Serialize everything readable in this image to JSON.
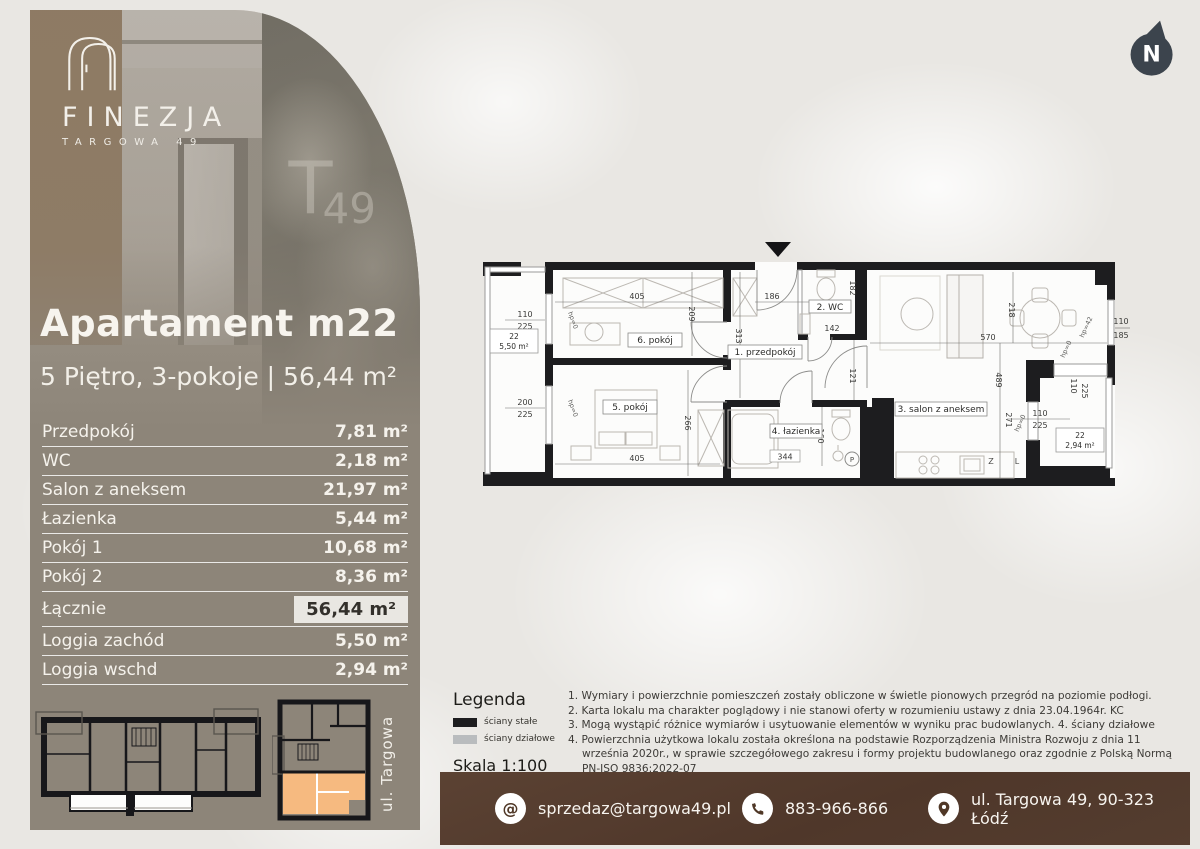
{
  "brand": {
    "name": "FINEZJA",
    "tagline": "TARGOWA 49",
    "mural_t": "T",
    "mural_49": "49"
  },
  "compass": {
    "label": "N"
  },
  "apartment": {
    "title": "Apartament m22",
    "subtitle": "5 Piętro, 3-pokoje | 56,44 m²"
  },
  "area_table": {
    "rows": [
      {
        "label": "Przedpokój",
        "value": "7,81 m²"
      },
      {
        "label": "WC",
        "value": "2,18 m²"
      },
      {
        "label": "Salon z aneksem",
        "value": "21,97 m²"
      },
      {
        "label": "Łazienka",
        "value": "5,44 m²"
      },
      {
        "label": "Pokój 1",
        "value": "10,68 m²"
      },
      {
        "label": "Pokój 2",
        "value": "8,36 m²"
      },
      {
        "label": "Łącznie",
        "value": "56,44 m²"
      },
      {
        "label": "Loggia zachód",
        "value": "5,50 m²"
      },
      {
        "label": "Loggia wschd",
        "value": "2,94 m²"
      }
    ]
  },
  "mini_plans": {
    "street_label": "ul. Targowa"
  },
  "floor_plan": {
    "rooms": {
      "hall": "1. przedpokój",
      "wc": "2. WC",
      "salon": "3. salon z aneksem",
      "bath": "4. łazienka",
      "room5": "5. pokój",
      "room6": "6. pokój"
    },
    "loggias": {
      "west": {
        "no": "22",
        "area": "5,50 m²"
      },
      "east": {
        "no": "22",
        "area": "2,94 m²"
      }
    },
    "dims": {
      "d405a": "405",
      "d209": "209",
      "d186": "186",
      "d313": "313",
      "d110a": "110",
      "d225a": "225",
      "d200": "200",
      "d225b": "225",
      "d266": "266",
      "d405b": "405",
      "d142": "142",
      "d182": "182",
      "d121": "121",
      "d160": "160",
      "d344": "344",
      "d570": "570",
      "d489": "489",
      "d218": "218",
      "d271": "271",
      "d110b": "110",
      "d185": "185",
      "d110c": "110",
      "d225c": "225",
      "d110d": "110",
      "d225d": "225"
    },
    "annotations": {
      "hp0": "hp=0",
      "hp42": "hp=42"
    },
    "letters": {
      "washer": "P",
      "sink": "Z",
      "fridge": "L"
    }
  },
  "legend": {
    "title": "Legenda",
    "solid_label": "ściany stałe",
    "partition_label": "ściany działowe",
    "scale": "Skala 1:100"
  },
  "notes": [
    "1. Wymiary i powierzchnie pomieszczeń zostały obliczone w świetle pionowych przegród na poziomie podłogi.",
    "2. Karta lokalu ma charakter poglądowy i nie stanowi oferty w rozumieniu ustawy z dnia 23.04.1964r. KC",
    "3. Mogą wystąpić różnice wymiarów i usytuowanie elementów w wyniku prac budowlanych. 4. ściany działowe",
    "4. Powierzchnia użytkowa lokalu została określona na podstawie Rozporządzenia Ministra Rozwoju z dnia 11 września 2020r., w sprawie szczegółowego zakresu i formy projektu budowlanego oraz zgodnie z Polską Normą PN-ISO 9836:2022-07"
  ],
  "contact": {
    "email": "sprzedaz@targowa49.pl",
    "phone": "883-966-866",
    "address": "ul. Targowa 49, 90-323 Łódź"
  },
  "colors": {
    "panel": "#8d8579",
    "bar": "#4f372a",
    "highlight_orange": "#f6ba80",
    "wall_solid": "#1d1d1f",
    "wall_partition": "#b9bcbe"
  }
}
